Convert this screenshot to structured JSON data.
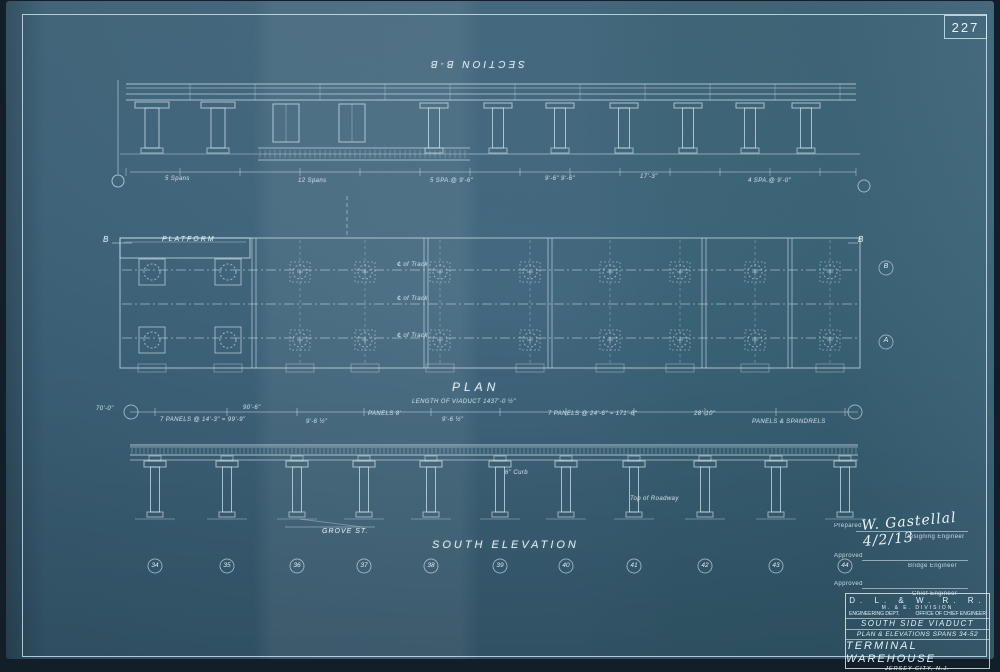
{
  "page": {
    "sheet_number_top": "227"
  },
  "labels": {
    "section_title": "SECTION B-B",
    "plan_title": "PLAN",
    "plan_subtitle": "LENGTH OF VIADUCT 1437'-0 ½\"",
    "platform": "PLATFORM",
    "b_marker_left": "B",
    "b_marker_right": "B",
    "elevation_title": "SOUTH ELEVATION",
    "grove_st": "GROVE ST.",
    "track_labels": [
      "℄ of Track",
      "℄ of Track",
      "℄ of Track"
    ],
    "bent_numbers": [
      "34",
      "35",
      "36",
      "37",
      "38",
      "39",
      "40",
      "41",
      "42",
      "43",
      "44"
    ],
    "margin_markers": [
      "B",
      "A"
    ],
    "dims_section": [
      "5 Spans",
      "12 Spans",
      "5 SPA.@ 9'-6\"",
      "9'-6\"  9'-6\"",
      "17'-3\"",
      "4 SPA.@ 9'-0\""
    ],
    "dims_elevation": [
      "70'-0\"",
      "7 PANELS @ 14'-3\" = 99'-9\"",
      "90'-6\"",
      "9'-6 ½\"",
      "PANELS 8'",
      "9'-6 ½\"",
      "7 PANELS @ 24'-6\" = 171'-6\"",
      "28'-10\"",
      "PANELS & SPANDRELS"
    ],
    "note_curb": "6\" Curb",
    "note_roadway": "Top of Roadway"
  },
  "signature": {
    "prepared_label": "Prepared",
    "signature": "W. Gastellal   4/2/13",
    "role1": "Designing Engineer",
    "approved_label": "Approved",
    "role2": "Bridge Engineer",
    "approved2_label": "Approved",
    "role3": "Chief Engineer"
  },
  "titleblock": {
    "railroad": "D. L. & W. R. R.",
    "division": "M. & E. DIVISION",
    "dept_left": "ENGINEERING DEPT.",
    "dept_right": "OFFICE OF CHIEF ENGINEER",
    "project": "SOUTH SIDE VIADUCT",
    "subtitle": "PLAN & ELEVATIONS SPANS 34-52",
    "title": "TERMINAL WAREHOUSE",
    "location": "JERSEY CITY, N.J.",
    "scale": "Scale 1\"=10'",
    "book": "Bridge Book",
    "sheet_number": "227",
    "credits": "Designed L.T.S.    Traced E.P.S.    Checked C.P.H.",
    "sheet_line": "Sheet 12 of sheets     Hoboken, N.J.     June 2, 1913"
  }
}
